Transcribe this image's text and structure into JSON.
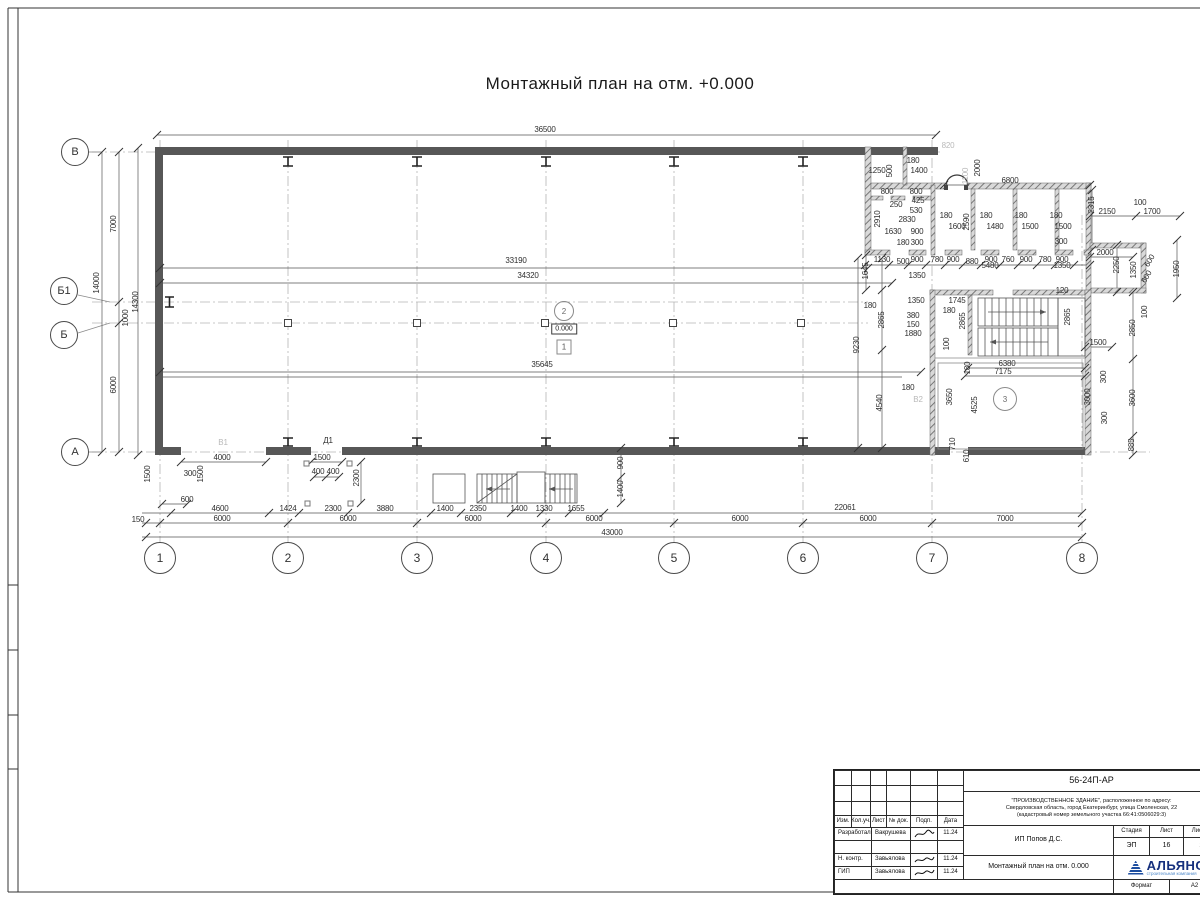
{
  "title": "Монтажный план на отм. +0.000",
  "plan": {
    "axes_bottom": [
      {
        "label": "1",
        "x": 160
      },
      {
        "label": "2",
        "x": 288
      },
      {
        "label": "3",
        "x": 417
      },
      {
        "label": "4",
        "x": 546
      },
      {
        "label": "5",
        "x": 674
      },
      {
        "label": "6",
        "x": 803
      },
      {
        "label": "7",
        "x": 932
      },
      {
        "label": "8",
        "x": 1082
      }
    ],
    "axes_left": [
      {
        "label": "В",
        "x": 75,
        "y": 152
      },
      {
        "label": "Б1",
        "x": 64,
        "y": 291
      },
      {
        "label": "Б",
        "x": 64,
        "y": 335
      },
      {
        "label": "А",
        "x": 75,
        "y": 452
      }
    ],
    "markers": {
      "level": "0.000",
      "zone_upper": "2",
      "zone_lower": "1",
      "room": "3"
    },
    "dims": [
      {
        "t": "36500",
        "x": 545,
        "y": 130
      },
      {
        "t": "6800",
        "x": 1010,
        "y": 181
      },
      {
        "t": "2150",
        "x": 1107,
        "y": 212
      },
      {
        "t": "100",
        "x": 1140,
        "y": 203
      },
      {
        "t": "1700",
        "x": 1152,
        "y": 212
      },
      {
        "t": "2315",
        "x": 1092,
        "y": 205,
        "r": -90
      },
      {
        "t": "2000",
        "x": 978,
        "y": 168,
        "r": -90
      },
      {
        "t": "820",
        "x": 948,
        "y": 146,
        "c": 1
      },
      {
        "t": "1100",
        "x": 966,
        "y": 176,
        "r": -90,
        "c": 1
      },
      {
        "t": "1250",
        "x": 877,
        "y": 171
      },
      {
        "t": "500",
        "x": 890,
        "y": 171,
        "r": -90
      },
      {
        "t": "180",
        "x": 913,
        "y": 161
      },
      {
        "t": "1400",
        "x": 919,
        "y": 171
      },
      {
        "t": "800",
        "x": 887,
        "y": 192
      },
      {
        "t": "800",
        "x": 916,
        "y": 192
      },
      {
        "t": "250",
        "x": 896,
        "y": 205
      },
      {
        "t": "425",
        "x": 918,
        "y": 201
      },
      {
        "t": "530",
        "x": 916,
        "y": 211
      },
      {
        "t": "2830",
        "x": 907,
        "y": 220
      },
      {
        "t": "2910",
        "x": 878,
        "y": 219,
        "r": -90
      },
      {
        "t": "1630",
        "x": 893,
        "y": 232
      },
      {
        "t": "900",
        "x": 917,
        "y": 232
      },
      {
        "t": "180",
        "x": 903,
        "y": 243
      },
      {
        "t": "300",
        "x": 917,
        "y": 243
      },
      {
        "t": "180",
        "x": 946,
        "y": 216
      },
      {
        "t": "1600",
        "x": 957,
        "y": 227
      },
      {
        "t": "2590",
        "x": 967,
        "y": 222,
        "r": -90
      },
      {
        "t": "180",
        "x": 986,
        "y": 216
      },
      {
        "t": "1480",
        "x": 995,
        "y": 227
      },
      {
        "t": "180",
        "x": 1021,
        "y": 216
      },
      {
        "t": "1500",
        "x": 1030,
        "y": 227
      },
      {
        "t": "180",
        "x": 1056,
        "y": 216
      },
      {
        "t": "1500",
        "x": 1063,
        "y": 227
      },
      {
        "t": "300",
        "x": 1061,
        "y": 242
      },
      {
        "t": "1130",
        "x": 882,
        "y": 260
      },
      {
        "t": "500",
        "x": 903,
        "y": 262
      },
      {
        "t": "900",
        "x": 917,
        "y": 260
      },
      {
        "t": "780",
        "x": 937,
        "y": 260
      },
      {
        "t": "900",
        "x": 953,
        "y": 260
      },
      {
        "t": "880",
        "x": 972,
        "y": 262
      },
      {
        "t": "900",
        "x": 991,
        "y": 260
      },
      {
        "t": "760",
        "x": 1008,
        "y": 260
      },
      {
        "t": "900",
        "x": 1026,
        "y": 260
      },
      {
        "t": "780",
        "x": 1045,
        "y": 260
      },
      {
        "t": "900",
        "x": 1062,
        "y": 260
      },
      {
        "t": "1645",
        "x": 866,
        "y": 271,
        "r": -90
      },
      {
        "t": "1350",
        "x": 917,
        "y": 276
      },
      {
        "t": "5480",
        "x": 990,
        "y": 266
      },
      {
        "t": "1350",
        "x": 1062,
        "y": 266
      },
      {
        "t": "120",
        "x": 1062,
        "y": 291
      },
      {
        "t": "14000",
        "x": 97,
        "y": 283,
        "r": -90
      },
      {
        "t": "7000",
        "x": 114,
        "y": 224,
        "r": -90
      },
      {
        "t": "14300",
        "x": 136,
        "y": 302,
        "r": -90
      },
      {
        "t": "1000",
        "x": 126,
        "y": 318,
        "r": -90
      },
      {
        "t": "6000",
        "x": 114,
        "y": 385,
        "r": -90
      },
      {
        "t": "1500",
        "x": 148,
        "y": 474,
        "r": -90
      },
      {
        "t": "150",
        "x": 138,
        "y": 520
      },
      {
        "t": "33190",
        "x": 516,
        "y": 261
      },
      {
        "t": "34320",
        "x": 528,
        "y": 276
      },
      {
        "t": "35645",
        "x": 542,
        "y": 365
      },
      {
        "t": "9230",
        "x": 857,
        "y": 345,
        "r": -90
      },
      {
        "t": "180",
        "x": 870,
        "y": 306
      },
      {
        "t": "2865",
        "x": 882,
        "y": 320,
        "r": -90
      },
      {
        "t": "380",
        "x": 913,
        "y": 316
      },
      {
        "t": "150",
        "x": 913,
        "y": 325
      },
      {
        "t": "1880",
        "x": 913,
        "y": 334
      },
      {
        "t": "1350",
        "x": 916,
        "y": 301
      },
      {
        "t": "1745",
        "x": 957,
        "y": 301
      },
      {
        "t": "180",
        "x": 949,
        "y": 311
      },
      {
        "t": "2865",
        "x": 963,
        "y": 321,
        "r": -90
      },
      {
        "t": "2865",
        "x": 1068,
        "y": 317,
        "r": -90
      },
      {
        "t": "100",
        "x": 947,
        "y": 344,
        "r": -90
      },
      {
        "t": "6380",
        "x": 1007,
        "y": 364
      },
      {
        "t": "7175",
        "x": 1003,
        "y": 372
      },
      {
        "t": "180",
        "x": 968,
        "y": 368,
        "r": -90
      },
      {
        "t": "4540",
        "x": 880,
        "y": 403,
        "r": -90
      },
      {
        "t": "180",
        "x": 908,
        "y": 388
      },
      {
        "t": "3650",
        "x": 950,
        "y": 397,
        "r": -90
      },
      {
        "t": "4525",
        "x": 975,
        "y": 405,
        "r": -90
      },
      {
        "t": "3000",
        "x": 1088,
        "y": 397,
        "r": -90
      },
      {
        "t": "710",
        "x": 953,
        "y": 444,
        "r": -90
      },
      {
        "t": "610",
        "x": 967,
        "y": 456,
        "r": -90
      },
      {
        "t": "2000",
        "x": 1105,
        "y": 253
      },
      {
        "t": "2250",
        "x": 1117,
        "y": 265,
        "r": -90
      },
      {
        "t": "1350",
        "x": 1134,
        "y": 270,
        "r": -90
      },
      {
        "t": "600",
        "x": 1150,
        "y": 261,
        "r": -60
      },
      {
        "t": "600",
        "x": 1147,
        "y": 277,
        "r": -60
      },
      {
        "t": "1950",
        "x": 1177,
        "y": 269,
        "r": -90
      },
      {
        "t": "100",
        "x": 1145,
        "y": 312,
        "r": -90
      },
      {
        "t": "2850",
        "x": 1133,
        "y": 328,
        "r": -90
      },
      {
        "t": "1500",
        "x": 1098,
        "y": 343
      },
      {
        "t": "300",
        "x": 1104,
        "y": 377,
        "r": -90
      },
      {
        "t": "300",
        "x": 1105,
        "y": 418,
        "r": -90
      },
      {
        "t": "3600",
        "x": 1133,
        "y": 398,
        "r": -90
      },
      {
        "t": "885",
        "x": 1132,
        "y": 445,
        "r": -90
      },
      {
        "t": "4000",
        "x": 222,
        "y": 458
      },
      {
        "t": "300",
        "x": 190,
        "y": 474
      },
      {
        "t": "1500",
        "x": 201,
        "y": 474,
        "r": -90
      },
      {
        "t": "600",
        "x": 187,
        "y": 500
      },
      {
        "t": "1500",
        "x": 322,
        "y": 458
      },
      {
        "t": "400",
        "x": 318,
        "y": 472
      },
      {
        "t": "400",
        "x": 333,
        "y": 472
      },
      {
        "t": "2300",
        "x": 357,
        "y": 478,
        "r": -90
      },
      {
        "t": "900",
        "x": 621,
        "y": 463,
        "r": -90
      },
      {
        "t": "1400",
        "x": 621,
        "y": 489,
        "r": -90
      },
      {
        "t": "4600",
        "x": 220,
        "y": 509
      },
      {
        "t": "1424",
        "x": 288,
        "y": 509
      },
      {
        "t": "2300",
        "x": 333,
        "y": 509
      },
      {
        "t": "3880",
        "x": 385,
        "y": 509
      },
      {
        "t": "1400",
        "x": 445,
        "y": 509
      },
      {
        "t": "2350",
        "x": 478,
        "y": 509
      },
      {
        "t": "1400",
        "x": 519,
        "y": 509
      },
      {
        "t": "1330",
        "x": 544,
        "y": 509
      },
      {
        "t": "1655",
        "x": 576,
        "y": 509
      },
      {
        "t": "22061",
        "x": 845,
        "y": 508
      },
      {
        "t": "6000",
        "x": 222,
        "y": 519
      },
      {
        "t": "6000",
        "x": 348,
        "y": 519
      },
      {
        "t": "6000",
        "x": 473,
        "y": 519
      },
      {
        "t": "6000",
        "x": 594,
        "y": 519
      },
      {
        "t": "6000",
        "x": 740,
        "y": 519
      },
      {
        "t": "6000",
        "x": 868,
        "y": 519
      },
      {
        "t": "7000",
        "x": 1005,
        "y": 519
      },
      {
        "t": "43000",
        "x": 612,
        "y": 533
      },
      {
        "t": "В1",
        "x": 223,
        "y": 443,
        "c": 1
      },
      {
        "t": "В2",
        "x": 918,
        "y": 400,
        "c": 1
      },
      {
        "t": "Д1",
        "x": 328,
        "y": 441
      }
    ]
  },
  "titleblock": {
    "doc_number": "56-24П-АР",
    "project_line1": "\"ПРОИЗВОДСТВЕННОЕ ЗДАНИЕ\", расположенное по адресу:",
    "project_line2": "Свердловская область, город Екатеринбург, улица Смоленская, 22",
    "project_line3": "(кадастровый номер земельного участка 66:41:0506029:3)",
    "client": "ИП Попов Д.С.",
    "sheet_title": "Монтажный план на отм. 0.000",
    "stage_label": "Стадия",
    "sheet_label": "Лист",
    "sheets_label": "Листов",
    "stage": "ЭП",
    "sheet": "16",
    "sheets": "2",
    "cols": {
      "izm": "Изм.",
      "kol": "Кол.уч.",
      "list": "Лист",
      "doc": "№ док.",
      "podp": "Подп.",
      "data": "Дата"
    },
    "rows": [
      {
        "role": "Разработал",
        "name": "Вакрушева",
        "date": "11.24"
      },
      {
        "role": "",
        "name": "",
        "date": ""
      },
      {
        "role": "Н. контр.",
        "name": "Завьялова",
        "date": "11.24"
      },
      {
        "role": "ГИП",
        "name": "Завьялова",
        "date": "11.24"
      }
    ],
    "format_label": "Формат",
    "format_value": "А2",
    "logo_text": "АЛЬЯНС",
    "logo_sub": "строительная компания"
  }
}
